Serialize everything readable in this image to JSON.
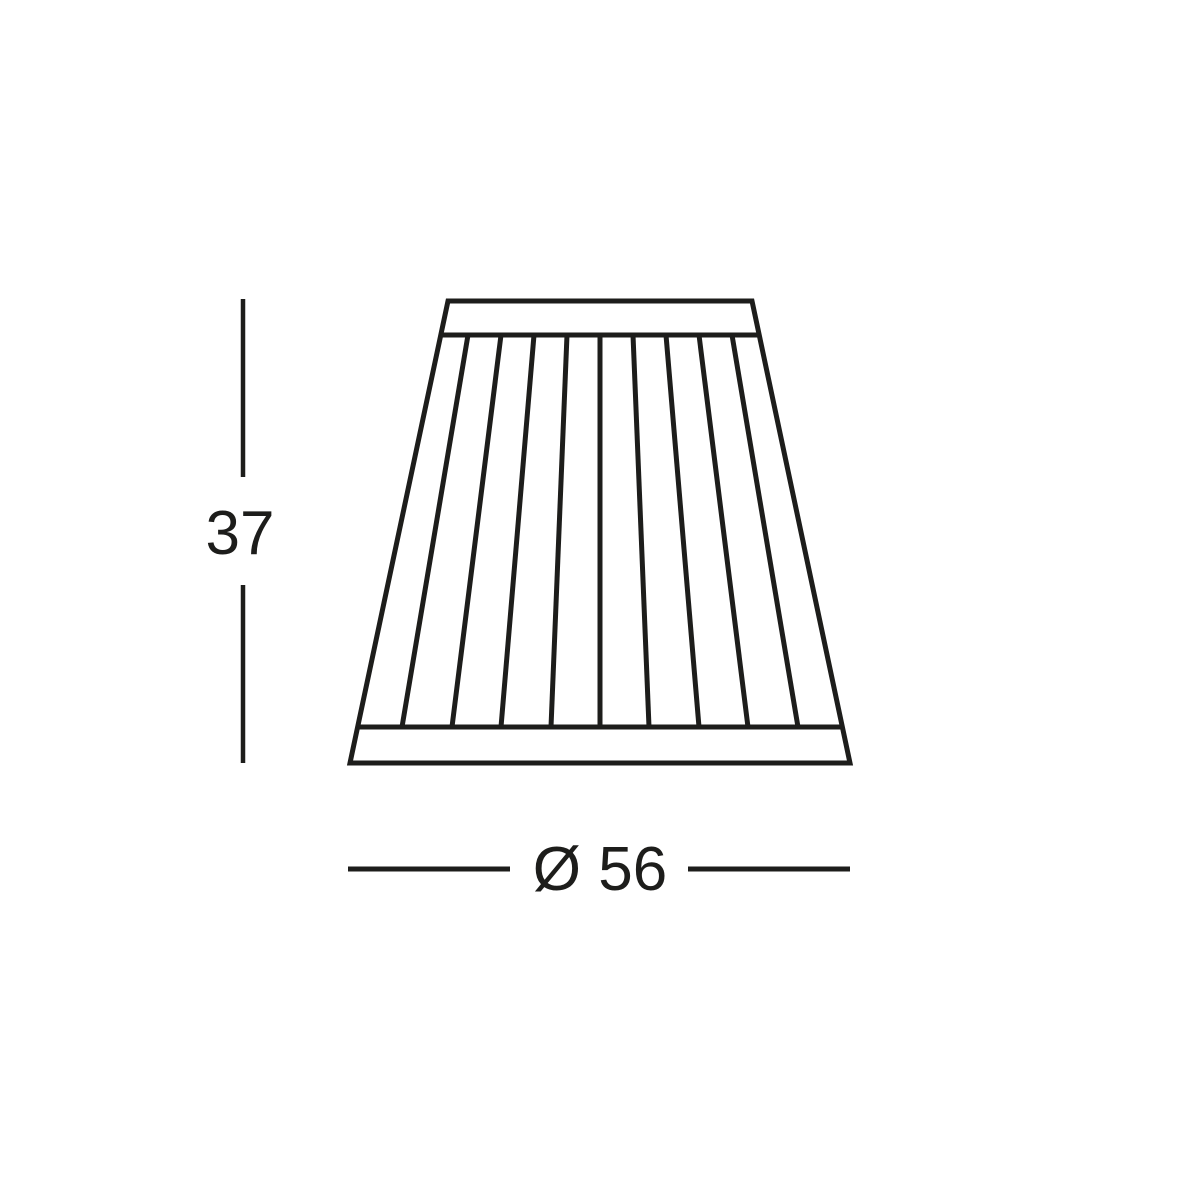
{
  "page": {
    "background_color": "#ffffff"
  },
  "drawing": {
    "name": "pleated-lampshade-dimension-diagram",
    "ink_color": "#1d1d1b",
    "pleat_panel_count": 10,
    "dimensions": {
      "height": {
        "label": "37"
      },
      "diameter": {
        "label": "Ø 56"
      }
    }
  }
}
